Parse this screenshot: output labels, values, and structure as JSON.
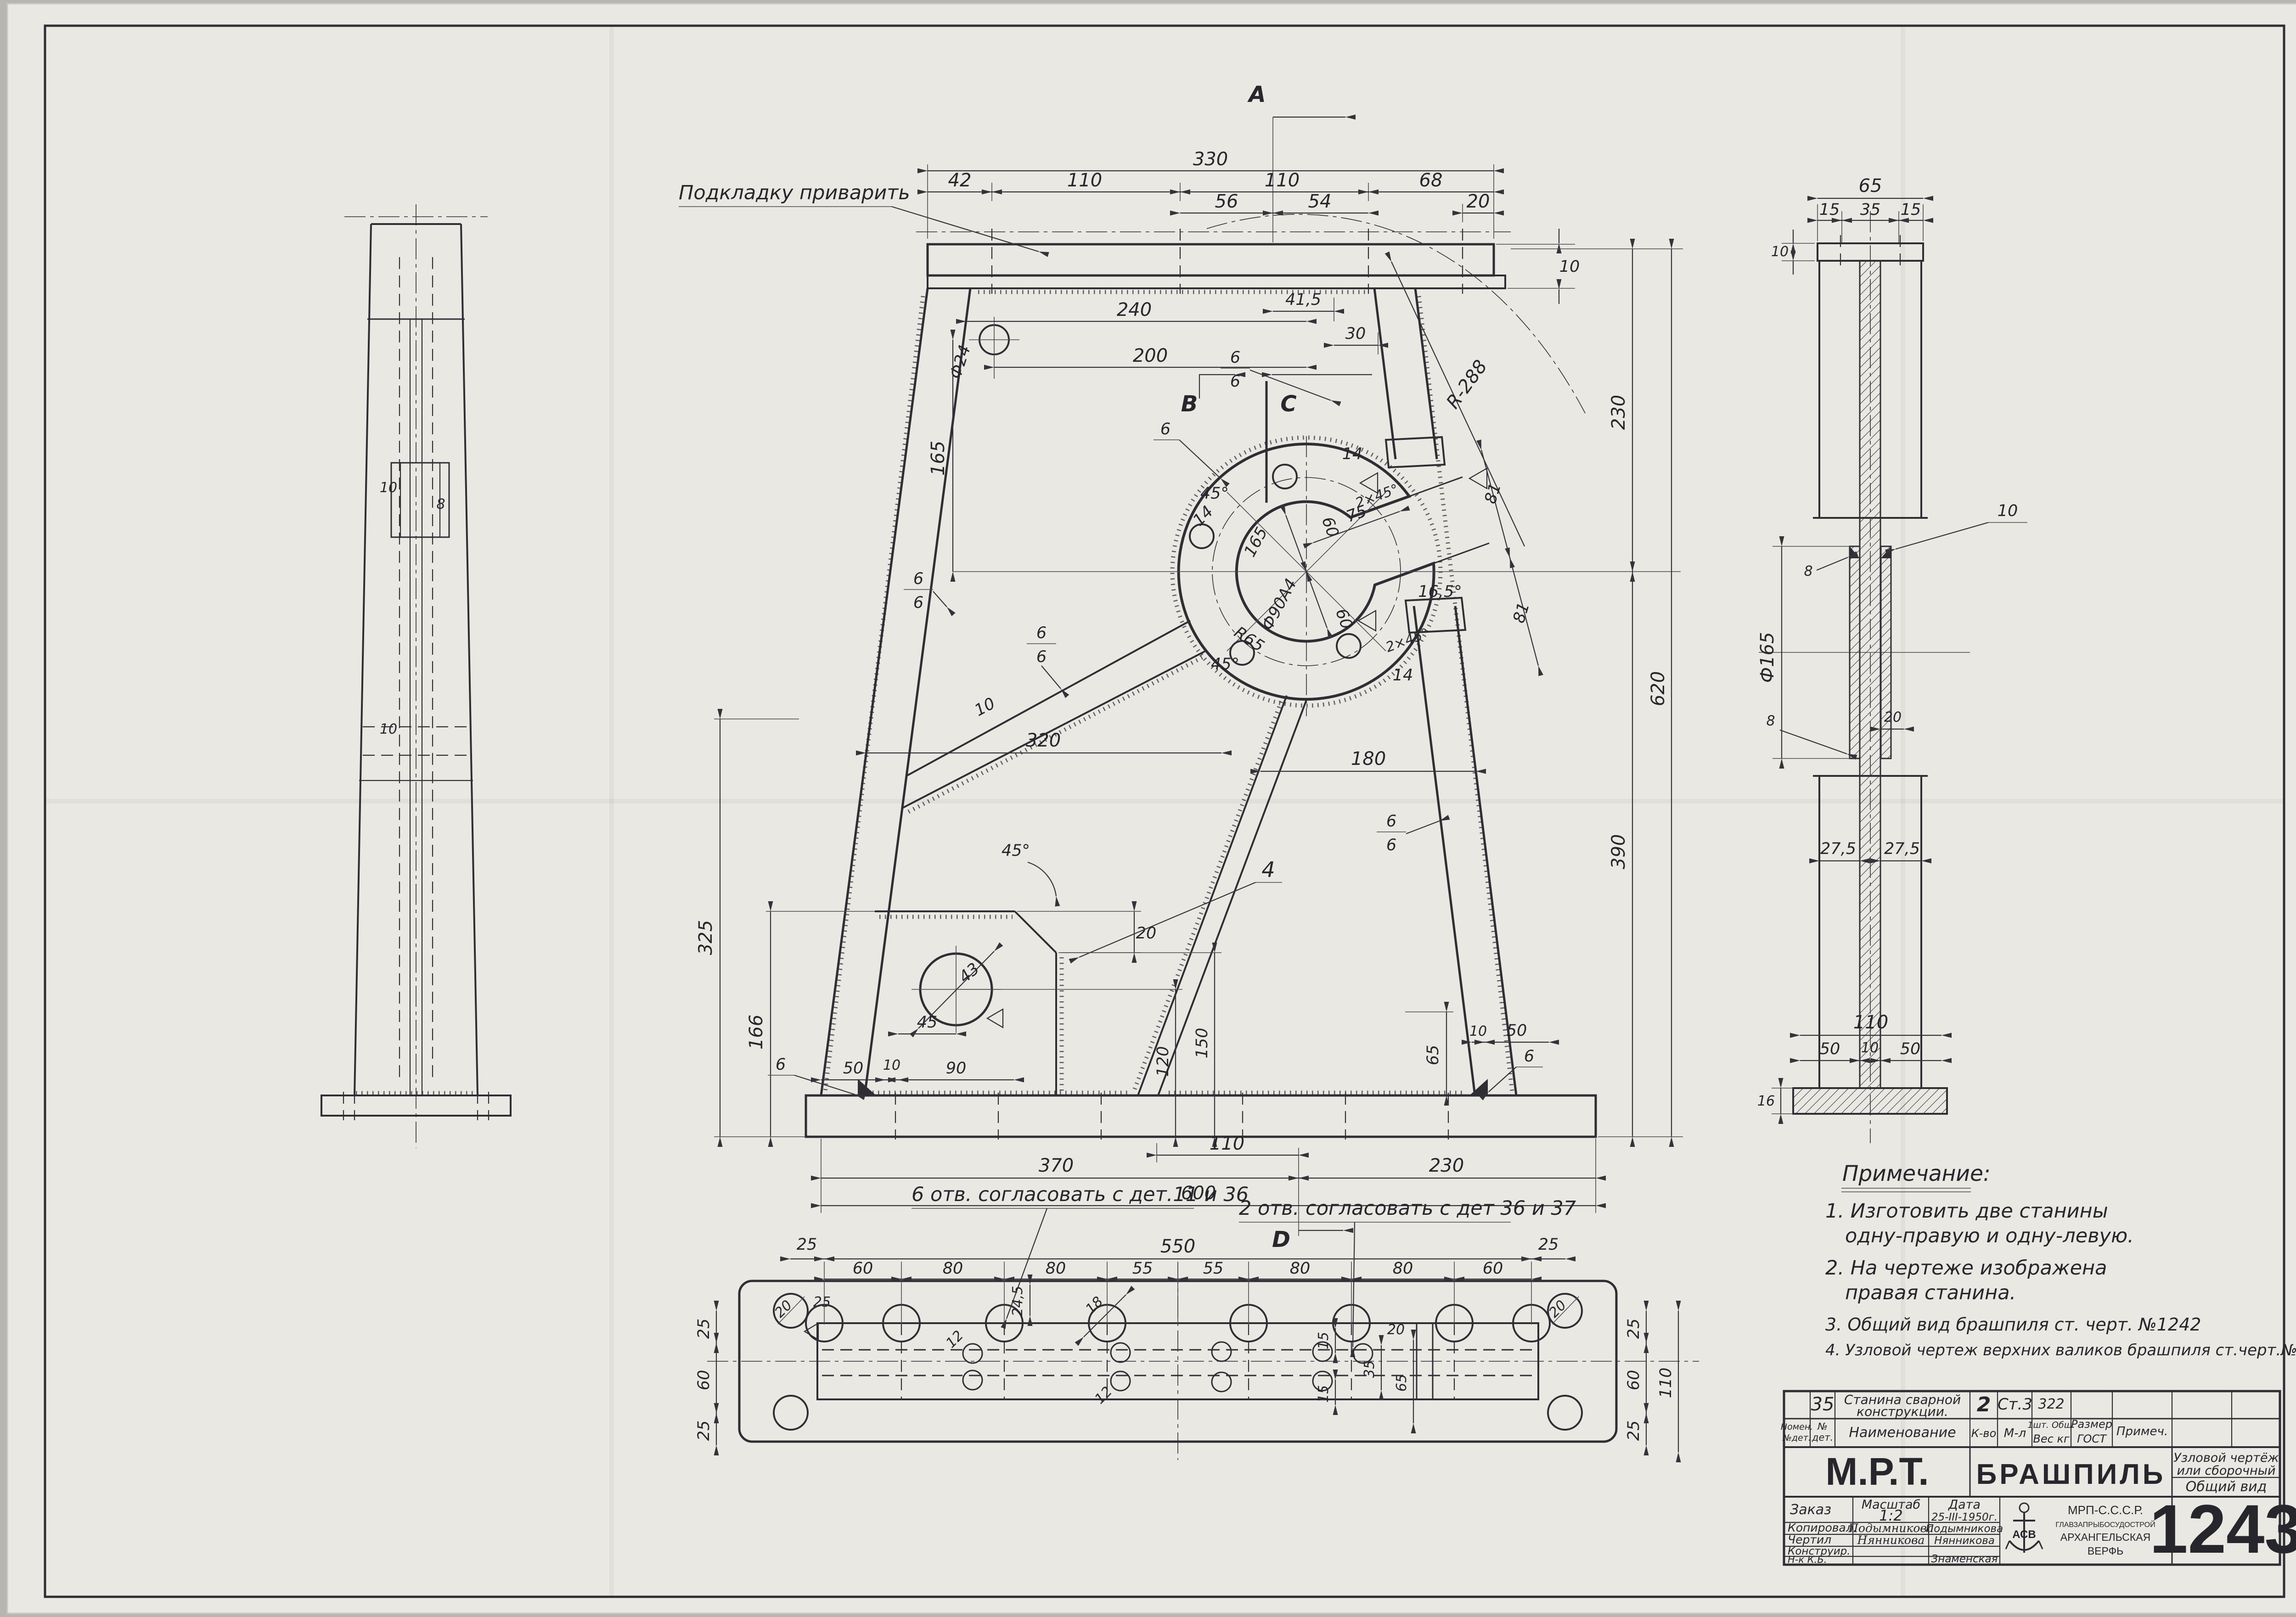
{
  "colors": {
    "paper": "#e9e8e2",
    "ink": "#2e2e34",
    "background": "#b7b6b1"
  },
  "t": {
    "a": "А",
    "b": "В",
    "c": "С",
    "d": "D",
    "n330": "330",
    "n42": "42",
    "n110": "110",
    "n68": "68",
    "n56": "56",
    "n54": "54",
    "n20": "20",
    "n10": "10",
    "n41_5": "41,5",
    "n30": "30",
    "r288": "R-288",
    "n240": "240",
    "n200": "200",
    "f24": "Ф24",
    "n165": "165",
    "n6": "6",
    "n14": "14",
    "ch45": "2×45°",
    "n81": "81",
    "n75": "75",
    "n60": "60",
    "a16_5": "16,5°",
    "f90": "Ф90А4",
    "r65": "R65",
    "a45": "45°",
    "n320": "320",
    "n180": "180",
    "n325": "325",
    "n166": "166",
    "c4": "4",
    "n43": "43",
    "n45": "45",
    "n90": "90",
    "n50": "50",
    "n120": "120",
    "n150": "150",
    "n65": "65",
    "n370": "370",
    "n230": "230",
    "n600": "600",
    "n390": "390",
    "n620": "620",
    "n550": "550",
    "n80": "80",
    "n55": "55",
    "n25": "25",
    "n24_5": "24,5",
    "n18": "18",
    "n15": "15",
    "n35": "35",
    "n12": "12",
    "n27_5": "27,5",
    "n16": "16",
    "f165": "Ф165",
    "n8": "8"
  },
  "ann": {
    "pad": "Подкладку приварить",
    "holes6": "6 отв. согласовать с дет.11 и 36",
    "holes2": "2 отв. согласовать с дет 36 и 37"
  },
  "notes": {
    "title": "Примечание:",
    "lines": [
      "1. Изготовить две станины",
      "одну-правую и одну-левую.",
      "2. На чертеже изображена",
      "правая станина.",
      "3. Общий вид брашпиля ст. черт. №1242",
      "4. Узловой чертеж верхних валиков брашпиля ст.черт.№1252"
    ]
  },
  "tb": {
    "item_no": "35",
    "name1": "Станина сварной",
    "name2": "конструкции.",
    "qty": "2",
    "material": "Ст.3",
    "weight": "322",
    "h_nomen1": "Номен.",
    "h_nomen2": "№дет.",
    "h_no1": "№",
    "h_no2": "дет.",
    "h_name": "Наименование",
    "h_qty": "К-во",
    "h_mat": "М-л",
    "h_sht": "1шт.  Общ.",
    "h_ves": "Вес кг",
    "h_razmer": "Размер",
    "h_gost": "ГОСТ",
    "h_prim": "Примеч.",
    "org": "М.Р.Т.",
    "product": "БРАШПИЛЬ",
    "doc1": "Узловой чертёж",
    "doc2": "или сборочный",
    "doc3": "Общий вид",
    "order": "Заказ",
    "scale_l": "Масштаб",
    "scale_v": "1:2",
    "date_l": "Дата",
    "date_v": "25-III-1950г.",
    "r_cop": "Копировал.",
    "r_draw": "Чертил",
    "r_des": "Конструир.",
    "r_chief": "Н-к К.Б.",
    "s_cop_sig": "Подымникова",
    "s_cop": "Подымникова",
    "s_draw_sig": "Нянникова",
    "s_draw": "Нянникова",
    "s_chief": "Знаменская",
    "comp1": "МРП-С.С.С.Р.",
    "comp2": "ГЛАВЗАПРЫБОСУДОСТРОЙ",
    "comp3": "АРХАНГЕЛЬСКАЯ",
    "comp4": "ВЕРФЬ",
    "logo": "АСВ",
    "number": "1243"
  }
}
